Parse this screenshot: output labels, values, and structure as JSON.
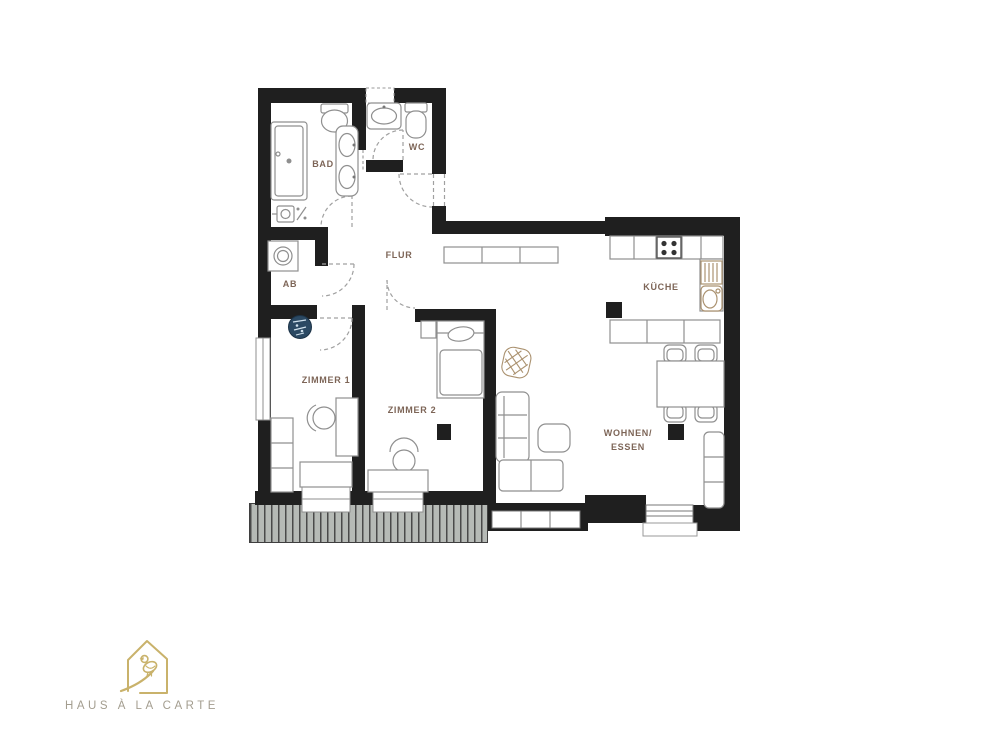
{
  "floorplan": {
    "rooms": {
      "bad": {
        "label": "BAD"
      },
      "wc": {
        "label": "WC"
      },
      "flur": {
        "label": "FLUR"
      },
      "ab": {
        "label": "AB"
      },
      "zimmer1": {
        "label": "ZIMMER 1"
      },
      "zimmer2": {
        "label": "ZIMMER 2"
      },
      "kueche": {
        "label": "KÜCHE"
      },
      "wohnen": {
        "line1": "WOHNEN/",
        "line2": "ESSEN"
      }
    },
    "icons": {
      "compass_stamp": "blue-compass-stamp",
      "plant_basket": "wicker-plant-basket"
    },
    "colors": {
      "wall": "#1f1f1f",
      "furniture_line": "#8f8f8f",
      "wood_accent": "#ab9270",
      "room_label": "#7d6557",
      "balcony_fill": "#b6bab6",
      "balcony_stripe": "#4a4a4a",
      "compass_blue": "#2b4963",
      "logo_gold": "#c9b26b",
      "logo_text": "#a39d8f"
    }
  },
  "logo": {
    "text": "HAUS À LA CARTE"
  }
}
